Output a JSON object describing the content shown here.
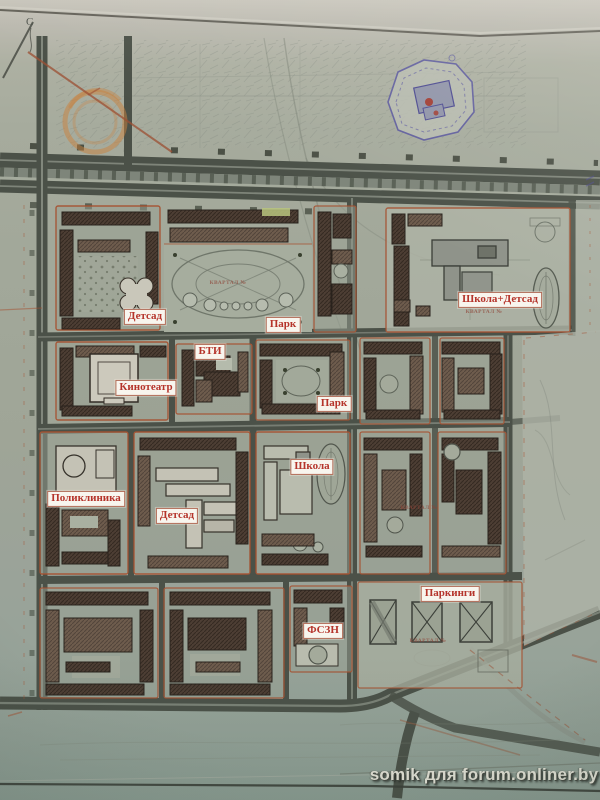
{
  "photo": {
    "watermark": "somik для forum.onliner.by",
    "north_label": "С"
  },
  "map_labels": [
    {
      "id": "detsad-1",
      "text": "Детсад",
      "x": 145,
      "y": 317
    },
    {
      "id": "park-1",
      "text": "Парк",
      "x": 283,
      "y": 325
    },
    {
      "id": "bti",
      "text": "БТИ",
      "x": 210,
      "y": 352
    },
    {
      "id": "kinoteatr",
      "text": "Кинотеатр",
      "x": 146,
      "y": 388
    },
    {
      "id": "shkola-detsad",
      "text": "Школа+Детсад",
      "x": 500,
      "y": 300
    },
    {
      "id": "park-2",
      "text": "Парк",
      "x": 334,
      "y": 404
    },
    {
      "id": "shkola",
      "text": "Школа",
      "x": 312,
      "y": 467
    },
    {
      "id": "poliklinika",
      "text": "Поликлиника",
      "x": 86,
      "y": 499
    },
    {
      "id": "detsad-2",
      "text": "Детсад",
      "x": 177,
      "y": 516
    },
    {
      "id": "parkingi",
      "text": "Паркинги",
      "x": 450,
      "y": 594
    },
    {
      "id": "fszn",
      "text": "ФСЗН",
      "x": 323,
      "y": 631
    }
  ],
  "quarter_labels": [
    {
      "text": "КВАРТАЛ №",
      "x": 228,
      "y": 283
    },
    {
      "text": "КВАРТАЛ №",
      "x": 484,
      "y": 312
    },
    {
      "text": "КВАРТАЛ №",
      "x": 419,
      "y": 508
    },
    {
      "text": "КВАРТАЛ №",
      "x": 428,
      "y": 641
    }
  ],
  "colors": {
    "label_text": "#b5342b",
    "label_bg": "#f8f5ee",
    "label_border": "#b06a55",
    "block_outline": "#a6502f",
    "stamp_orange": "#c9813e",
    "ink_blue": "#57549e",
    "road": "#4b5148",
    "building": "#4d3e34",
    "paper": "#a2a89a"
  }
}
